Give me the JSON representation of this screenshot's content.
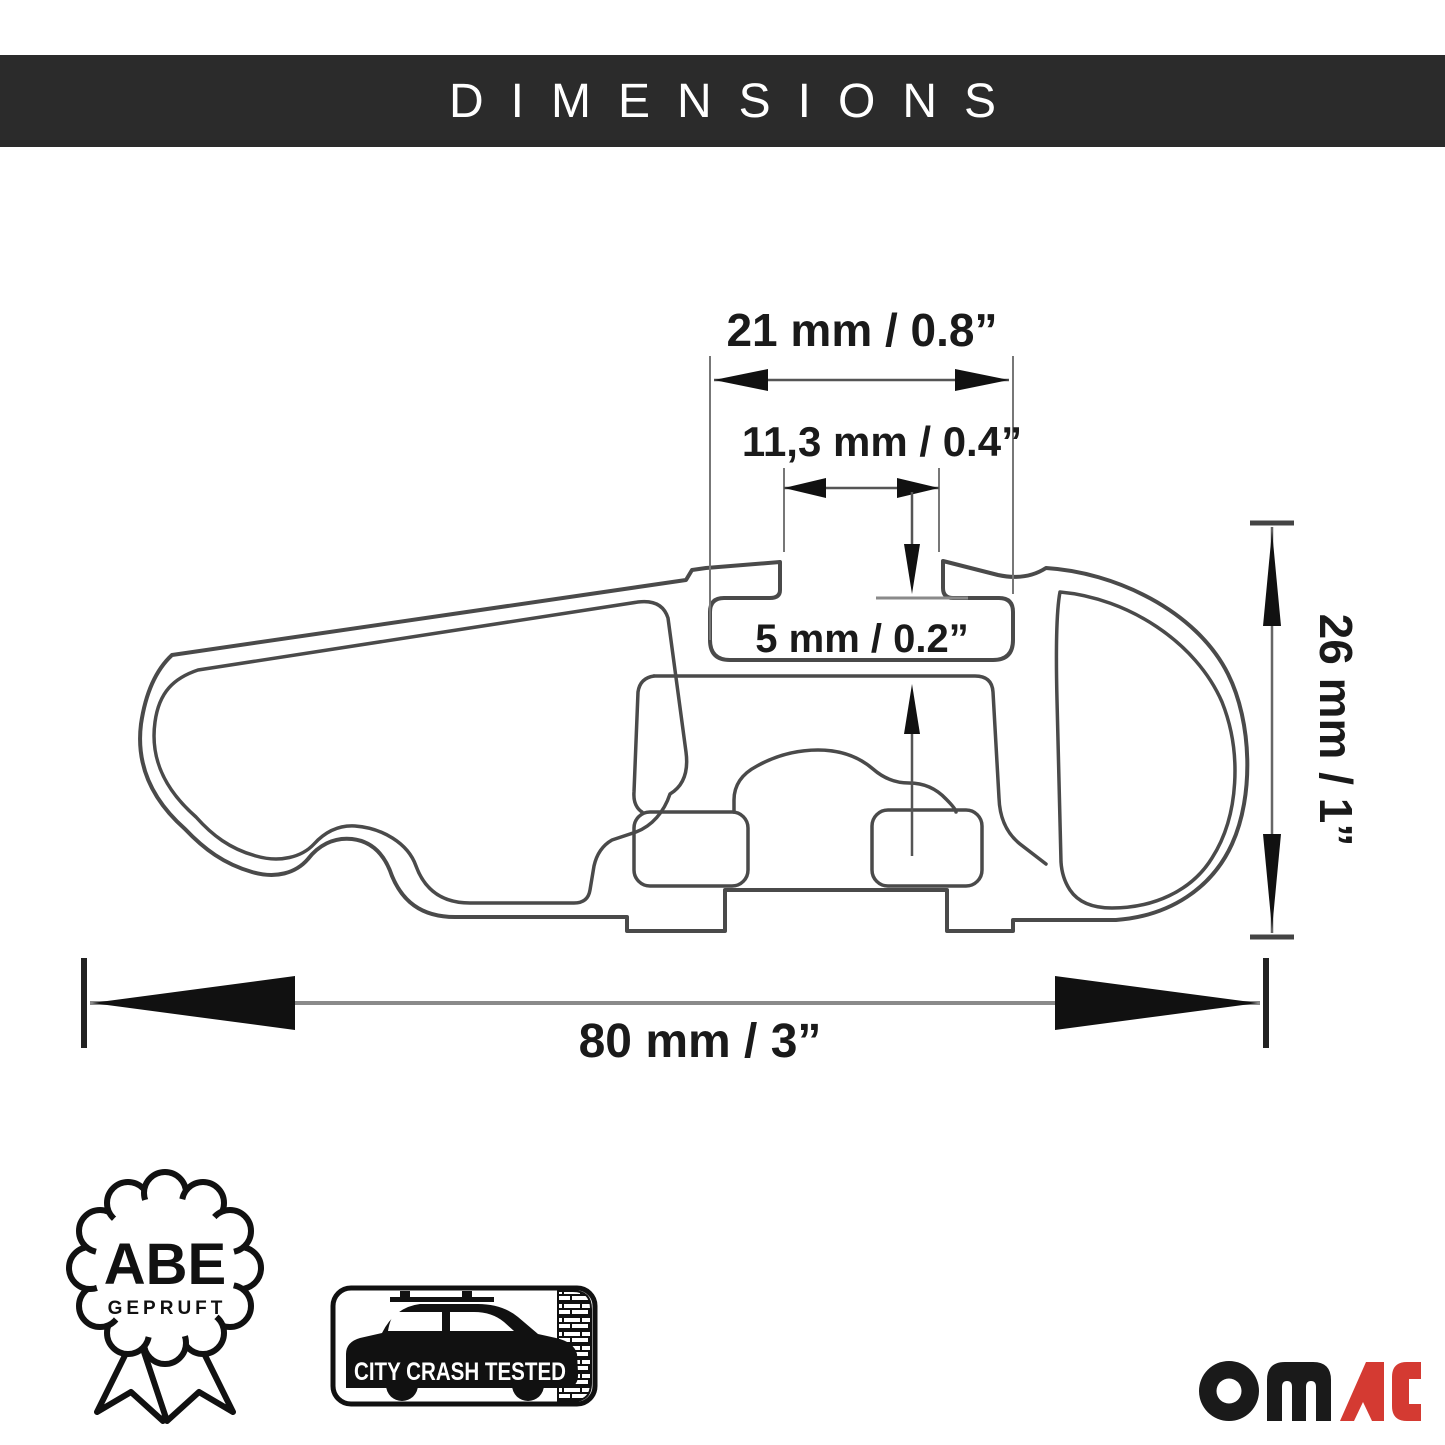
{
  "header": {
    "title": "DIMENSIONS",
    "background": "#2b2b2b",
    "text_color": "#ffffff"
  },
  "diagram": {
    "line_color": "#4a4a4a",
    "dimension_line_color": "#666666",
    "arrow_color": "#111111",
    "labels": {
      "slot_inner_width": "21 mm / 0.8”",
      "slot_opening_width": "11,3 mm / 0.4”",
      "wall_thickness": "5 mm / 0.2”",
      "profile_height": "26 mm / 1”",
      "profile_width": "80 mm / 3”"
    }
  },
  "badges": {
    "abe": {
      "title": "ABE",
      "subtitle": "GEPRUFT"
    },
    "crash_test": {
      "label": "CITY CRASH TESTED"
    }
  },
  "logo": {
    "text": "OMAC",
    "black_part": "OM",
    "red_part": "AC",
    "red": "#d43a32",
    "black": "#1a1a1a"
  }
}
